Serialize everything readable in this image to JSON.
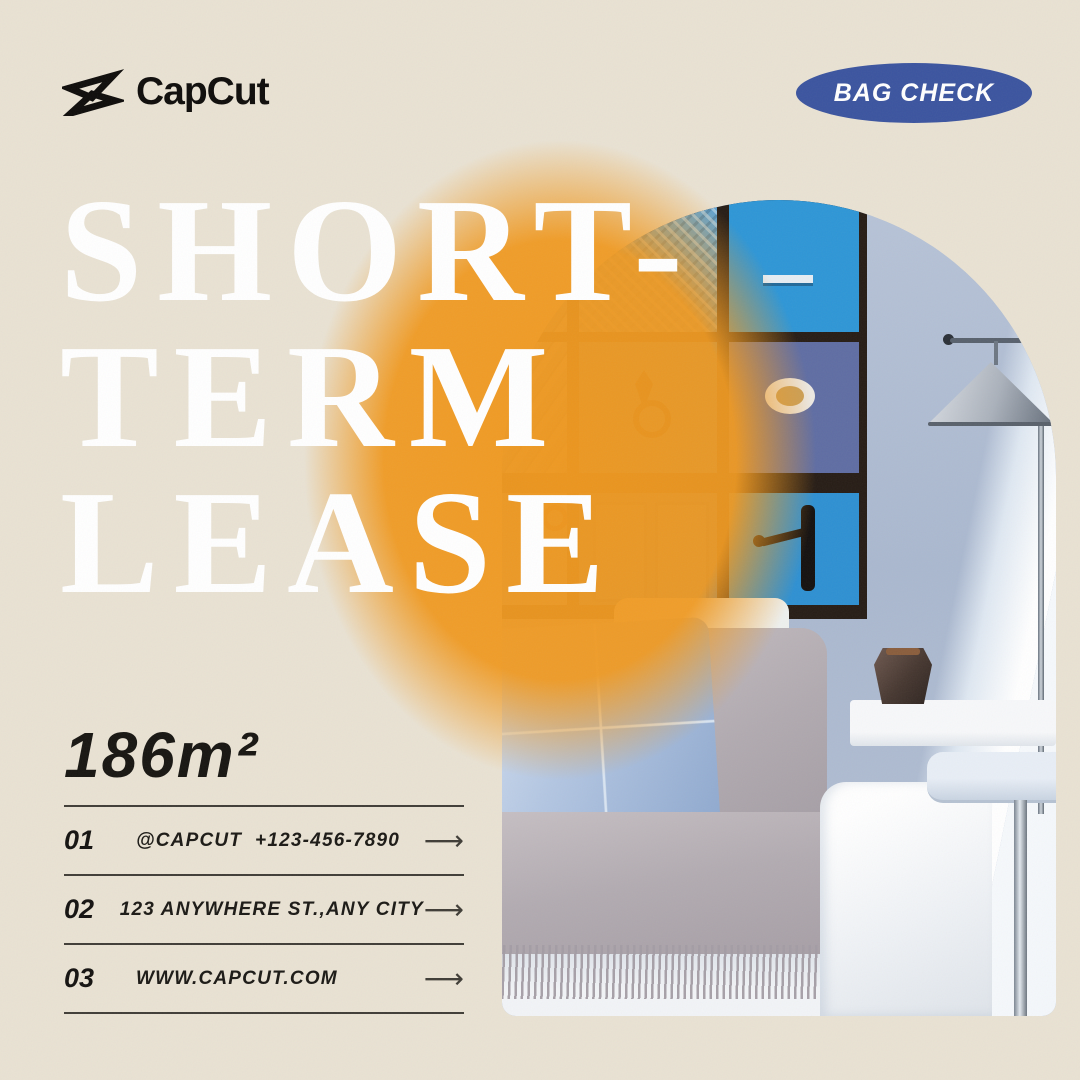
{
  "page": {
    "background_color": "#e9e2d3"
  },
  "brand": {
    "name": "CapCut"
  },
  "badge": {
    "label": "BAG CHECK",
    "bg_color": "#3b549f",
    "text_color": "#ffffff"
  },
  "headline": {
    "line1": "SHORT-",
    "line2": "TERM",
    "line3": "LEASE",
    "color": "#ffffff"
  },
  "area_label": "186m²",
  "contact": {
    "arrow": "⟶",
    "rows": [
      {
        "num": "01",
        "text": "@CAPCUT  +123-456-7890"
      },
      {
        "num": "02",
        "text": "123 ANYWHERE ST.,ANY CITY"
      },
      {
        "num": "03",
        "text": "WWW.CAPCUT.COM"
      }
    ]
  },
  "colors": {
    "accent_orange": "#f0992a",
    "badge_blue": "#3b549f",
    "text_dark": "#1b1915",
    "door_blues": [
      "#2e96d6",
      "#3089cb",
      "#5f6da3",
      "#2d74c0",
      "#2e90d2"
    ]
  }
}
